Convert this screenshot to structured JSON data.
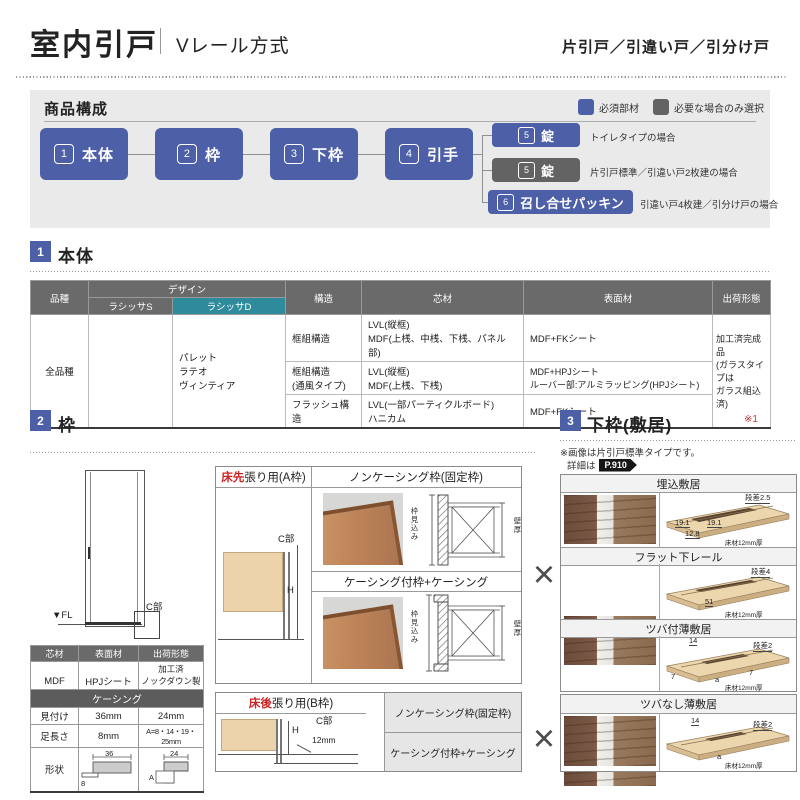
{
  "page": {
    "title": "室内引戸",
    "subtitle": "Vレール方式",
    "door_types": "片引戸／引違い戸／引分け戸"
  },
  "composition": {
    "title": "商品構成",
    "legend": [
      {
        "label": "必須部材"
      },
      {
        "label": "必要な場合のみ選択"
      }
    ],
    "flow": [
      {
        "num": "1",
        "label": "本体"
      },
      {
        "num": "2",
        "label": "枠"
      },
      {
        "num": "3",
        "label": "下枠"
      },
      {
        "num": "4",
        "label": "引手"
      }
    ],
    "branches": [
      {
        "num": "5",
        "label": "錠",
        "note": "トイレタイプの場合"
      },
      {
        "num": "5",
        "label": "錠",
        "note": "片引戸標準／引違い戸2枚建の場合"
      },
      {
        "num": "6",
        "label": "召し合せパッキン",
        "note": "引違い戸4枚建／引分け戸の場合"
      }
    ]
  },
  "body_section": {
    "num": "1",
    "title": "本体",
    "table": {
      "col_kind": "品種",
      "col_design": "デザイン",
      "col_design_s": "ラシッサS",
      "col_design_d": "ラシッサD",
      "col_structure": "構造",
      "col_core": "芯材",
      "col_surface": "表面材",
      "col_shipping": "出荷形態",
      "kind_value": "全品種",
      "design_d_value": "パレット\nラテオ\nヴィンティア",
      "rows": [
        {
          "structure": "框組構造",
          "core": "LVL(縦框)\nMDF(上桟、中桟、下桟、パネル部)",
          "surface": "MDF+FKシート"
        },
        {
          "structure": "框組構造\n(通風タイプ)",
          "core": "LVL(縦框)\nMDF(上桟、下桟)",
          "surface": "MDF+HPJシート\nルーバー部:アルミラッピング(HPJシート)"
        },
        {
          "structure": "フラッシュ構造",
          "core": "LVL(一部パーティクルボード)\nハニカム",
          "surface": "MDF+FKシート"
        }
      ],
      "shipping_value": "加工済完成品\n(ガラスタイプは\nガラス組込済)"
    }
  },
  "frame_section": {
    "num": "2",
    "title": "枠",
    "door_diagram": {
      "fl": "▼FL",
      "c": "C部"
    },
    "materials": {
      "h_core": "芯材",
      "h_surface": "表面材",
      "h_shipping": "出荷形態",
      "core": "MDF",
      "surface": "HPJシート",
      "shipping": "加工済\nノックダウン製品"
    },
    "casing": {
      "title": "ケーシング",
      "row1_label": "見付け",
      "row1_v1": "36mm",
      "row1_v2": "24mm",
      "row2_label": "足長さ",
      "row2_v1": "8mm",
      "row2_v2": "A=8・14・19・25mm",
      "row3_label": "形状",
      "dim36": "36",
      "dim24": "24",
      "dim8": "8",
      "dimA": "A"
    },
    "box_a": {
      "tag_red": "床先",
      "tag_rest": "張り用(A枠)",
      "c": "C部",
      "h": "H",
      "noncasing": "ノンケーシング枠(固定枠)",
      "casing": "ケーシング付枠+ケーシング",
      "depth": "枠見込み",
      "wall": "壁厚"
    },
    "box_b": {
      "tag_red": "床後",
      "tag_rest": "張り用(B枠)",
      "c": "C部",
      "h": "H",
      "dim12": "12mm",
      "noncasing": "ノンケーシング枠(固定枠)",
      "casing": "ケーシング付枠+ケーシング"
    }
  },
  "sill_section": {
    "num": "3",
    "title": "下枠(敷居)",
    "ref": "※1",
    "note1": "※画像は片引戸標準タイプです。",
    "note2": "詳細は",
    "note2_badge": "P.910",
    "cross": "×",
    "items": [
      {
        "title": "埋込敷居",
        "step": "段差2.5",
        "d1": "19.1",
        "d2": "19.1",
        "d3": "12.8",
        "floor": "床材12mm厚"
      },
      {
        "title": "フラット下レール",
        "step": "段差4",
        "d1": "51",
        "floor": "床材12mm厚"
      },
      {
        "title": "ツバ付薄敷居",
        "step": "段差2",
        "d0": "14",
        "d1": "7",
        "d2": "a",
        "d3": "7",
        "floor": "床材12mm厚"
      },
      {
        "title": "ツバなし薄敷居",
        "step": "段差2",
        "d0": "14",
        "d2": "a",
        "floor": "床材12mm厚"
      }
    ]
  }
}
